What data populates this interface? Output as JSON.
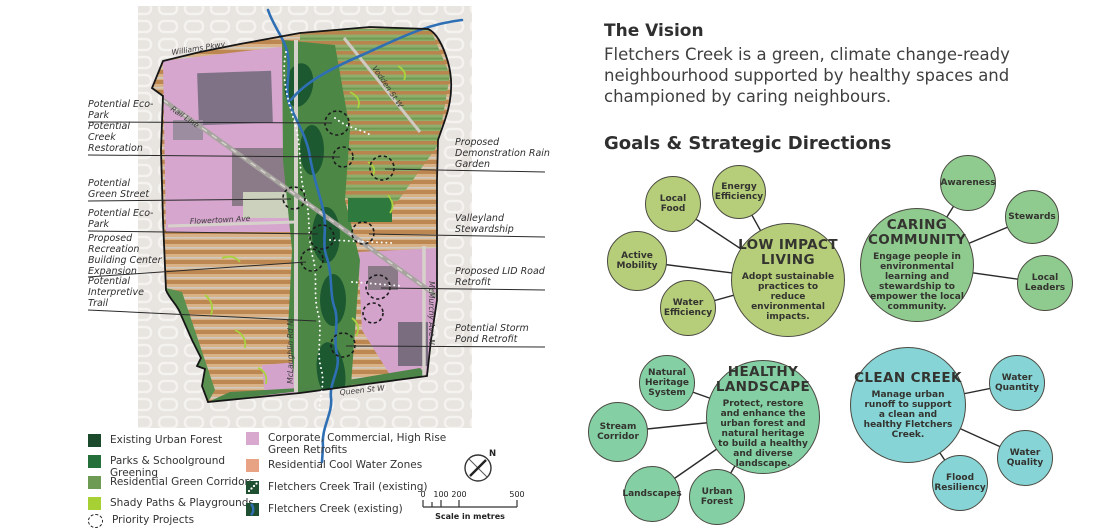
{
  "vision": {
    "heading": "The Vision",
    "body_lines": [
      "Fletchers Creek is a green, climate change-ready",
      "neighbourhood supported by healthy spaces and",
      "championed by caring neighbours."
    ]
  },
  "goals_heading": "Goals & Strategic Directions",
  "goals": [
    {
      "id": "low-impact-living",
      "title": "LOW IMPACT LIVING",
      "description": "Adopt sustainable practices to reduce environmental impacts.",
      "color": "#b6cd7a",
      "satellites": [
        {
          "label": "Local Food"
        },
        {
          "label": "Energy Efficiency"
        },
        {
          "label": "Active Mobility"
        },
        {
          "label": "Water Efficiency"
        }
      ]
    },
    {
      "id": "caring-community",
      "title": "CARING COMMUNITY",
      "description": "Engage people in environmental learning and stewardship to empower the local community.",
      "color": "#8fca8e",
      "satellites": [
        {
          "label": "Awareness"
        },
        {
          "label": "Stewards"
        },
        {
          "label": "Local Leaders"
        }
      ]
    },
    {
      "id": "healthy-landscape",
      "title": "HEALTHY LANDSCAPE",
      "description": "Protect, restore and enhance the urban forest and natural heritage to build a healthy and diverse landscape.",
      "color": "#84cfa4",
      "satellites": [
        {
          "label": "Natural Heritage System"
        },
        {
          "label": "Stream Corridor"
        },
        {
          "label": "Landscapes"
        },
        {
          "label": "Urban Forest"
        }
      ]
    },
    {
      "id": "clean-creek",
      "title": "CLEAN CREEK",
      "description": "Manage urban runoff to support a clean and healthy Fletchers Creek.",
      "color": "#86d4d6",
      "satellites": [
        {
          "label": "Water Quantity"
        },
        {
          "label": "Water Quality"
        },
        {
          "label": "Flood Resiliency"
        }
      ]
    }
  ],
  "map": {
    "streets": {
      "williams_pkwy": "Williams Pkwy",
      "rail_line": "Rail Line",
      "vodden_st": "Vodden St W",
      "flowertown_ave": "Flowertown Ave",
      "mclaughlin_rd": "McLaughlin Rd N",
      "mcmurchy_ave": "McMurchy Ave N",
      "queen_st": "Queen St W"
    },
    "callouts_left": [
      {
        "label": "Potential Eco-Park"
      },
      {
        "label": "Potential Creek Restoration"
      },
      {
        "label": "Potential Green Street"
      },
      {
        "label": "Potential Eco-Park"
      },
      {
        "label": "Proposed Recreation Building Center Expansion"
      },
      {
        "label": "Potential Interpretive Trail"
      }
    ],
    "callouts_right": [
      {
        "label": "Proposed Demonstration Rain Garden"
      },
      {
        "label": "Valleyland Stewardship"
      },
      {
        "label": "Proposed LID Road Retrofit"
      },
      {
        "label": "Potential Storm Pond Retrofit"
      }
    ],
    "compass_label": "N",
    "scale": {
      "ticks": [
        "0",
        "100",
        "200",
        "500"
      ],
      "caption": "Scale in metres"
    }
  },
  "legend": {
    "items_left": [
      {
        "label": "Existing Urban Forest",
        "swatch": "fill",
        "color": "#1b4a2c"
      },
      {
        "label": "Parks & Schoolground Greening",
        "swatch": "fill",
        "color": "#25703a"
      },
      {
        "label": "Residential Green Corridors",
        "swatch": "fill",
        "color": "#6d9b53"
      },
      {
        "label": "Shady Paths & Playgrounds",
        "swatch": "fill",
        "color": "#a6d034"
      },
      {
        "label": "Priority Projects",
        "swatch": "dashed-circle",
        "color": "#222222"
      }
    ],
    "items_right": [
      {
        "label": "Corporate, Commercial, High Rise Green Retrofits",
        "swatch": "fill",
        "color": "#d9a8ce"
      },
      {
        "label": "Residential Cool Water Zones",
        "swatch": "fill",
        "color": "#e8a284"
      },
      {
        "label": "Fletchers Creek Trail (existing)",
        "swatch": "trail",
        "color": "#1e4f30"
      },
      {
        "label": "Fletchers Creek (existing)",
        "swatch": "creek",
        "color": "#1e4f30"
      }
    ]
  }
}
